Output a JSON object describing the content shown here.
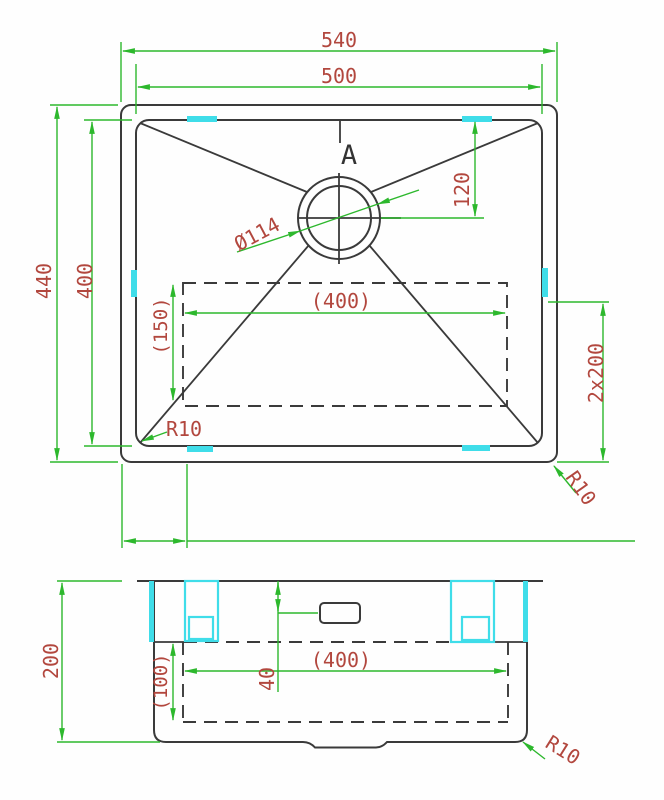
{
  "drawing_title": "Sink technical drawing",
  "colors": {
    "dimension_lines": "#2db82d",
    "annotation_text": "#b2473e",
    "outline": "#3a3a3a",
    "highlight_clips": "#3fdde9"
  },
  "top_view": {
    "labels": {
      "overall_width": "540",
      "inner_width": "500",
      "overall_height": "440",
      "inner_height": "400",
      "drain_offset": "120",
      "drain_diameter": "Ø114",
      "section_marker": "A",
      "base_width": "(400)",
      "base_height": "(150)",
      "inner_corner_radius": "R10",
      "outer_corner_radius": "R10",
      "drain_spacing": "2x200"
    }
  },
  "side_view": {
    "labels": {
      "overall_depth": "200",
      "base_depth": "(100)",
      "base_width": "(400)",
      "overflow_offset": "40",
      "corner_radius": "R10"
    }
  }
}
